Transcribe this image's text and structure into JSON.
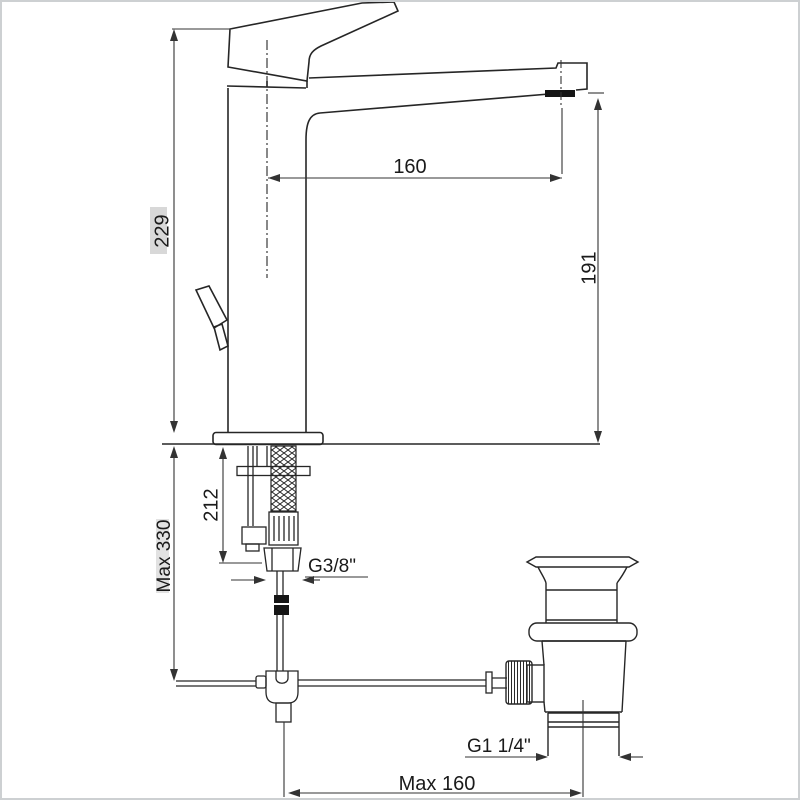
{
  "drawing": {
    "dimensions": {
      "total_height": "229",
      "spout_reach": "160",
      "outlet_height": "191",
      "underdeck_length": "212",
      "max_installation_depth": "Max 330",
      "supply_connection": "G3/8\"",
      "waste_connection": "G1 1/4\"",
      "max_rod_distance": "Max 160"
    },
    "colors": {
      "line": "#262626",
      "dim_line": "#333333",
      "fill_dark": "#151515",
      "background": "#ffffff",
      "border": "#cdd0d2",
      "label_highlight": "#d8d8d8"
    }
  }
}
